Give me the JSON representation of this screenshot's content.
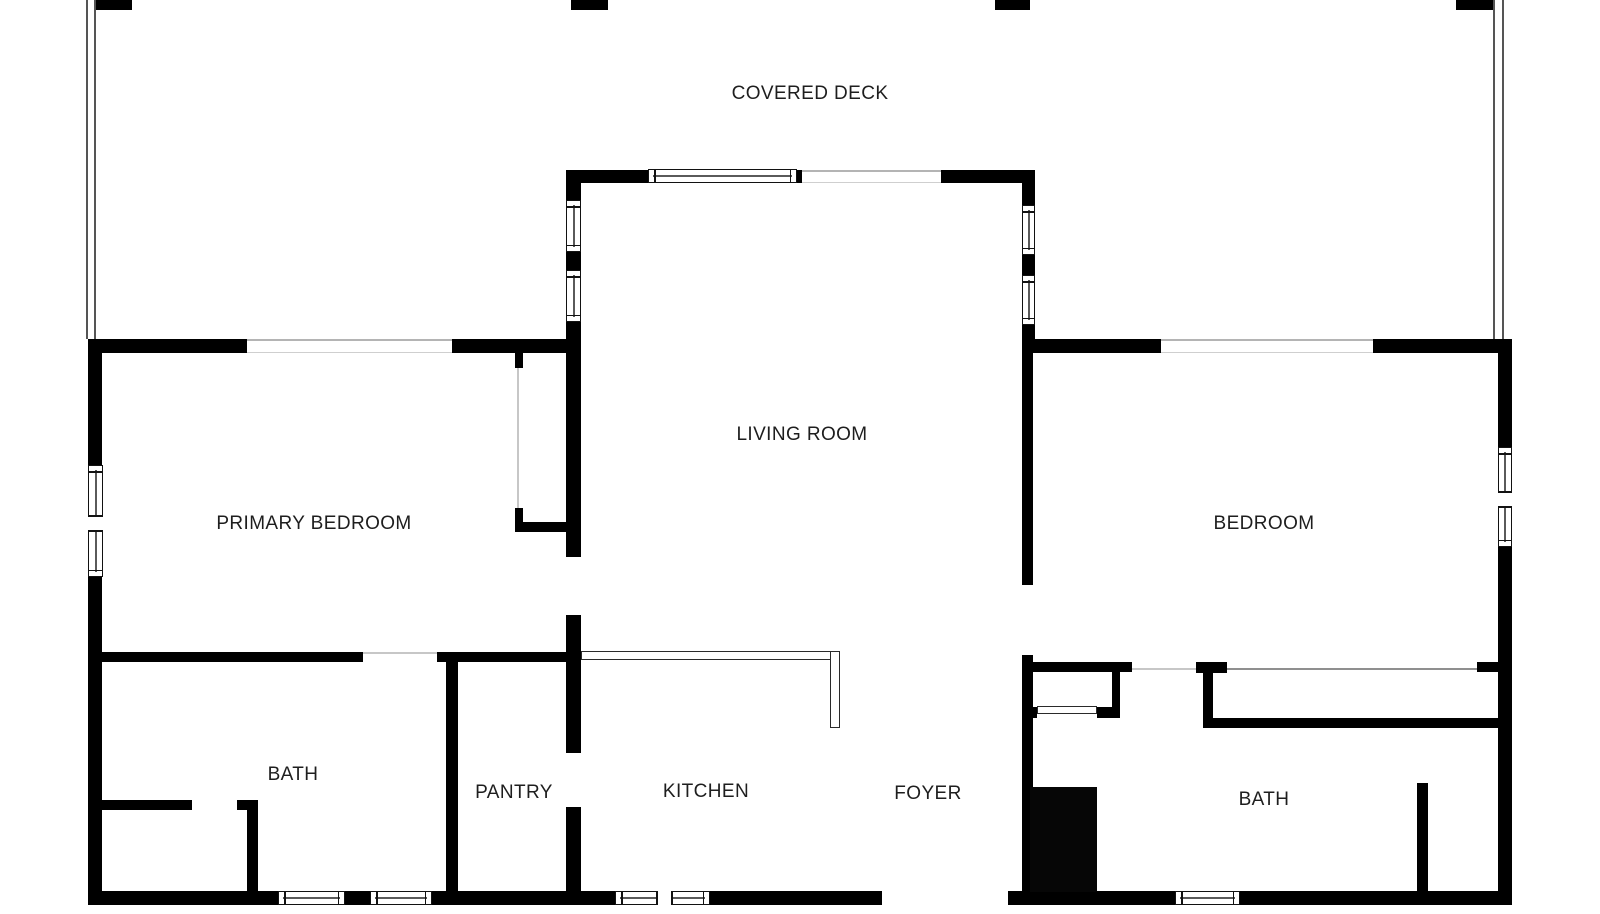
{
  "plan": {
    "colors": {
      "wall": "#000000",
      "background": "#ffffff",
      "text": "#1e1e1e",
      "thin_opening_line": "#c7c7c7",
      "glazing_line": "#b4b4b4"
    },
    "labels": [
      {
        "id": "covered-deck",
        "text": "COVERED DECK",
        "cx": 810,
        "cy": 94
      },
      {
        "id": "living-room",
        "text": "LIVING ROOM",
        "cx": 802,
        "cy": 435
      },
      {
        "id": "primary-bedroom",
        "text": "PRIMARY BEDROOM",
        "cx": 314,
        "cy": 524
      },
      {
        "id": "bedroom",
        "text": "BEDROOM",
        "cx": 1264,
        "cy": 524
      },
      {
        "id": "bath-left",
        "text": "BATH",
        "cx": 293,
        "cy": 775
      },
      {
        "id": "pantry",
        "text": "PANTRY",
        "cx": 514,
        "cy": 793
      },
      {
        "id": "kitchen",
        "text": "KITCHEN",
        "cx": 706,
        "cy": 792
      },
      {
        "id": "foyer",
        "text": "FOYER",
        "cx": 928,
        "cy": 794
      },
      {
        "id": "bath-right",
        "text": "BATH",
        "cx": 1264,
        "cy": 800
      }
    ],
    "walls": [
      [
        88,
        339,
        14,
        126
      ],
      [
        88,
        577,
        14,
        328
      ],
      [
        88,
        339,
        159,
        14
      ],
      [
        452,
        339,
        129,
        14
      ],
      [
        1022,
        339,
        139,
        14
      ],
      [
        1373,
        339,
        139,
        14
      ],
      [
        1498,
        339,
        14,
        108
      ],
      [
        1498,
        547,
        14,
        358
      ],
      [
        88,
        891,
        190,
        14
      ],
      [
        345,
        891,
        25,
        14
      ],
      [
        432,
        891,
        183,
        14
      ],
      [
        710,
        891,
        172,
        14
      ],
      [
        1008,
        891,
        167,
        14
      ],
      [
        1240,
        891,
        272,
        14
      ],
      [
        566,
        170,
        82,
        13
      ],
      [
        797,
        170,
        5,
        13
      ],
      [
        941,
        170,
        94,
        13
      ],
      [
        566,
        183,
        15,
        17
      ],
      [
        566,
        252,
        15,
        18
      ],
      [
        566,
        322,
        15,
        30
      ],
      [
        566,
        352,
        15,
        205
      ],
      [
        566,
        615,
        15,
        138
      ],
      [
        566,
        807,
        15,
        98
      ],
      [
        1022,
        183,
        13,
        22
      ],
      [
        1022,
        255,
        13,
        20
      ],
      [
        1022,
        325,
        13,
        27
      ],
      [
        1022,
        352,
        11,
        233
      ],
      [
        1022,
        655,
        11,
        250
      ],
      [
        102,
        652,
        261,
        10
      ],
      [
        437,
        652,
        144,
        10
      ],
      [
        446,
        652,
        12,
        253
      ],
      [
        515,
        352,
        8,
        16
      ],
      [
        515,
        508,
        8,
        23
      ],
      [
        515,
        522,
        62,
        10
      ],
      [
        102,
        800,
        90,
        10
      ],
      [
        237,
        800,
        21,
        10
      ],
      [
        247,
        810,
        11,
        82
      ],
      [
        1022,
        662,
        110,
        10
      ],
      [
        1112,
        662,
        8,
        56
      ],
      [
        1022,
        707,
        15,
        11
      ],
      [
        1097,
        707,
        23,
        11
      ],
      [
        1196,
        662,
        31,
        11
      ],
      [
        1203,
        662,
        10,
        66
      ],
      [
        1203,
        718,
        295,
        10
      ],
      [
        1477,
        662,
        21,
        10
      ],
      [
        1417,
        783,
        11,
        109
      ]
    ],
    "deck": {
      "posts": [
        [
          95,
          0,
          37,
          10
        ],
        [
          571,
          0,
          37,
          10
        ],
        [
          995,
          0,
          35,
          10
        ],
        [
          1456,
          0,
          37,
          10
        ]
      ],
      "rails": [
        [
          86,
          0,
          2,
          339
        ],
        [
          94,
          0,
          2,
          339
        ],
        [
          1493,
          0,
          2,
          339
        ],
        [
          1502,
          0,
          2,
          339
        ]
      ]
    },
    "glazing_bands": [
      {
        "x": 247,
        "y": 339,
        "w": 205,
        "h": 14
      },
      {
        "x": 1161,
        "y": 339,
        "w": 212,
        "h": 14
      },
      {
        "x": 802,
        "y": 170,
        "w": 139,
        "h": 13
      }
    ],
    "opening_lines": [
      {
        "x": 363,
        "y": 652,
        "w": 74,
        "h": 2,
        "dark": false
      },
      {
        "x": 1132,
        "y": 668,
        "w": 64,
        "h": 2,
        "dark": false
      },
      {
        "x": 1227,
        "y": 668,
        "w": 250,
        "h": 2,
        "dark": true
      },
      {
        "x": 517,
        "y": 368,
        "w": 2,
        "h": 140,
        "dark": false
      }
    ],
    "outlined_shapes": [
      {
        "id": "kitchen-counter-top",
        "x": 581,
        "y": 651,
        "w": 259,
        "h": 9
      },
      {
        "id": "kitchen-counter-side",
        "x": 830,
        "y": 651,
        "w": 10,
        "h": 77
      },
      {
        "id": "hall-closet-door",
        "x": 1037,
        "y": 706,
        "w": 60,
        "h": 8
      }
    ],
    "windows": [
      {
        "id": "primary-bedroom-left-window",
        "x": 88,
        "y": 465,
        "w": 15,
        "h": 112,
        "orient": "v",
        "divider": true
      },
      {
        "id": "bedroom-right-window",
        "x": 1498,
        "y": 447,
        "w": 14,
        "h": 100,
        "orient": "v",
        "divider": true
      },
      {
        "id": "living-room-left-window-1",
        "x": 566,
        "y": 200,
        "w": 15,
        "h": 52,
        "orient": "v",
        "divider": false
      },
      {
        "id": "living-room-left-window-2",
        "x": 566,
        "y": 270,
        "w": 15,
        "h": 52,
        "orient": "v",
        "divider": false
      },
      {
        "id": "living-room-right-window-1",
        "x": 1022,
        "y": 205,
        "w": 13,
        "h": 50,
        "orient": "v",
        "divider": false
      },
      {
        "id": "living-room-right-window-2",
        "x": 1022,
        "y": 275,
        "w": 13,
        "h": 50,
        "orient": "v",
        "divider": false
      },
      {
        "id": "living-room-top-window",
        "x": 648,
        "y": 169,
        "w": 149,
        "h": 14,
        "orient": "h",
        "divider": false
      },
      {
        "id": "kitchen-bottom-window",
        "x": 615,
        "y": 891,
        "w": 95,
        "h": 14,
        "orient": "h",
        "divider": true
      },
      {
        "id": "bath-left-bottom-window-1",
        "x": 278,
        "y": 891,
        "w": 67,
        "h": 14,
        "orient": "h",
        "divider": false
      },
      {
        "id": "bath-left-bottom-window-2",
        "x": 370,
        "y": 891,
        "w": 62,
        "h": 14,
        "orient": "h",
        "divider": false
      },
      {
        "id": "bath-right-bottom-window",
        "x": 1175,
        "y": 891,
        "w": 65,
        "h": 14,
        "orient": "h",
        "divider": false
      }
    ],
    "solid_masses": [
      {
        "id": "foyer-solid-mass",
        "x": 1030,
        "y": 787,
        "w": 67,
        "h": 105
      }
    ]
  }
}
